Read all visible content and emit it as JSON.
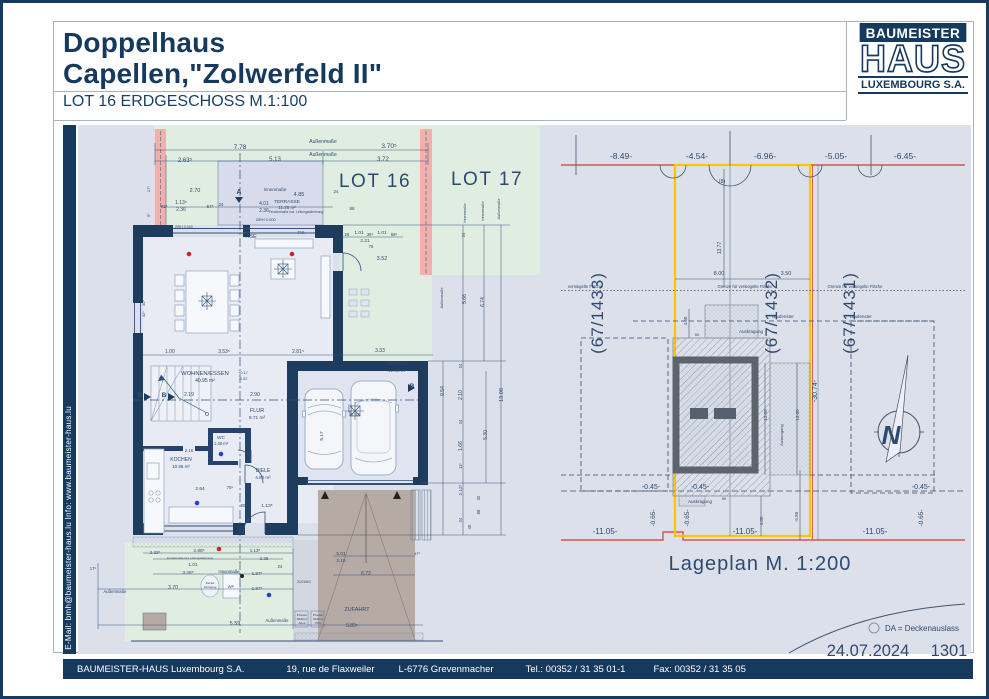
{
  "header": {
    "title_line1": "Doppelhaus",
    "title_line2": "Capellen,\"Zolwerfeld II\"",
    "subtitle": "LOT 16 ERDGESCHOSS  M.1:100"
  },
  "logo": {
    "top": "BAUMEISTER",
    "middle": "HAUS",
    "bottom": "LUXEMBOURG S.A."
  },
  "sidebar": {
    "contact": "E-Mail: bmh@baumeister-haus.lu    Info:    www.baumeister-haus.lu"
  },
  "footer": {
    "company": "BAUMEISTER-HAUS Luxembourg S.A.",
    "address": "19, rue de Flaxweiler",
    "city": "L-6776 Grevenmacher",
    "tel": "Tel.: 00352 / 31 35 01-1",
    "fax": "Fax: 00352 / 31 35 05"
  },
  "colors": {
    "navy": "#16395e",
    "drawing_bg": "#dbe0eb",
    "lot_green": "#dfeee0",
    "firewall_pink": "#f1b0ac",
    "terrace": "#d7dbeb",
    "driveway_taupe": "#b5aaa4",
    "boundary_red": "#d95448",
    "boundary_yellow": "#fdc500",
    "north_blue": "#1b1bdd"
  },
  "floor_plan": {
    "labels": [
      {
        "t": "Außenmaße",
        "x": 320,
        "y": 140,
        "s": 5
      },
      {
        "t": "7.78",
        "x": 237,
        "y": 146,
        "s": 6.5
      },
      {
        "t": "3.70⁵",
        "x": 386,
        "y": 145,
        "s": 6.5
      },
      {
        "t": "Außenmaße",
        "x": 320,
        "y": 153,
        "s": 5
      },
      {
        "t": "2.63⁵",
        "x": 182,
        "y": 159,
        "s": 6
      },
      {
        "t": "5.13",
        "x": 272,
        "y": 158,
        "s": 6
      },
      {
        "t": "3.72",
        "x": 380,
        "y": 158,
        "s": 6
      },
      {
        "t": "LOT 16",
        "x": 372,
        "y": 184,
        "s": 19,
        "c": "#2e4d73",
        "ls": 1.5,
        "n": "lot16-label"
      },
      {
        "t": "LOT 17",
        "x": 484,
        "y": 182,
        "s": 19,
        "c": "#2e4d73",
        "ls": 1.5,
        "n": "lot17-label"
      },
      {
        "t": "Innenmaße",
        "x": 272,
        "y": 188,
        "s": 4.5
      },
      {
        "t": "2.70",
        "x": 192,
        "y": 189,
        "s": 5.5
      },
      {
        "t": "4.85",
        "x": 296,
        "y": 193,
        "s": 5.5
      },
      {
        "t": "A",
        "x": 236,
        "y": 191,
        "s": 7,
        "b": 1,
        "n": "section-marker-a"
      },
      {
        "t": "TERRASSE",
        "x": 284,
        "y": 200,
        "s": 4.8,
        "n": "room-terrasse"
      },
      {
        "t": "11.25 m²",
        "x": 284,
        "y": 206,
        "s": 4.5
      },
      {
        "t": "92⁵",
        "x": 161,
        "y": 205,
        "s": 4.5
      },
      {
        "t": "1.13⁵",
        "x": 178,
        "y": 201,
        "s": 5
      },
      {
        "t": "2.36",
        "x": 178,
        "y": 208,
        "s": 5
      },
      {
        "t": "57⁵",
        "x": 207,
        "y": 205,
        "s": 4.5
      },
      {
        "t": "24",
        "x": 218,
        "y": 203,
        "s": 4.5
      },
      {
        "t": "4.01",
        "x": 261,
        "y": 202,
        "s": 5
      },
      {
        "t": "2.36",
        "x": 261,
        "y": 209,
        "s": 5
      },
      {
        "t": "Fenstermaße incl. Leitungsdämmung",
        "x": 293,
        "y": 210,
        "s": 3.3
      },
      {
        "t": "BRH 0.000",
        "x": 263,
        "y": 218,
        "s": 4
      },
      {
        "t": "88",
        "x": 349,
        "y": 207,
        "s": 4.5
      },
      {
        "t": "24",
        "x": 333,
        "y": 190,
        "s": 4.5
      },
      {
        "t": "17⁵",
        "x": 147,
        "y": 186,
        "s": 4,
        "r": -90
      },
      {
        "t": "9⁵",
        "x": 147,
        "y": 212,
        "s": 4,
        "r": -90
      },
      {
        "t": "30⁵",
        "x": 142,
        "y": 300,
        "s": 4,
        "r": -90
      },
      {
        "t": "42⁵",
        "x": 142,
        "y": 311,
        "s": 4,
        "r": -90
      },
      {
        "t": "BRH 0.000",
        "x": 181,
        "y": 225,
        "s": 3.6
      },
      {
        "t": "HSE",
        "x": 248,
        "y": 235,
        "s": 5.5
      },
      {
        "t": "FIX",
        "x": 298,
        "y": 231,
        "s": 4.5
      },
      {
        "t": "26",
        "x": 344,
        "y": 233,
        "s": 4.2
      },
      {
        "t": "1.01",
        "x": 356,
        "y": 231,
        "s": 4.8
      },
      {
        "t": "36⁵",
        "x": 367,
        "y": 233,
        "s": 4.2
      },
      {
        "t": "1.01",
        "x": 379,
        "y": 231,
        "s": 4.8
      },
      {
        "t": "69⁵",
        "x": 391,
        "y": 233,
        "s": 4.2
      },
      {
        "t": "2.21",
        "x": 362,
        "y": 239,
        "s": 4.8
      },
      {
        "t": "76",
        "x": 368,
        "y": 245,
        "s": 4.2
      },
      {
        "t": "3.52",
        "x": 379,
        "y": 257,
        "s": 5.5
      },
      {
        "t": "WOHNEN/ESSEN",
        "x": 202,
        "y": 372,
        "s": 5.8,
        "n": "room-wohnen-essen"
      },
      {
        "t": "40.95 m²",
        "x": 202,
        "y": 379,
        "s": 5
      },
      {
        "t": "1.00",
        "x": 167,
        "y": 350,
        "s": 5
      },
      {
        "t": "3.53⁵",
        "x": 221,
        "y": 350,
        "s": 5
      },
      {
        "t": "2.81⁵",
        "x": 295,
        "y": 350,
        "s": 5
      },
      {
        "t": "3.33",
        "x": 377,
        "y": 349,
        "s": 5
      },
      {
        "t": "GARAGE",
        "x": 394,
        "y": 362,
        "s": 5.5,
        "n": "room-garage"
      },
      {
        "t": "41.90 m²",
        "x": 394,
        "y": 369,
        "s": 4.8
      },
      {
        "t": "B",
        "x": 137,
        "y": 394,
        "s": 6.5,
        "b": 1,
        "n": "section-marker-b"
      },
      {
        "t": "B",
        "x": 161,
        "y": 394,
        "s": 6.5,
        "b": 1,
        "n": "section-marker-b"
      },
      {
        "t": "B",
        "x": 409,
        "y": 385,
        "s": 6.5,
        "b": 1,
        "n": "section-marker-b"
      },
      {
        "t": "2.19",
        "x": 186,
        "y": 393,
        "s": 5
      },
      {
        "t": "2.90",
        "x": 252,
        "y": 393,
        "s": 5
      },
      {
        "t": "+0.17",
        "x": 240,
        "y": 371,
        "s": 3.8
      },
      {
        "t": "-0.02",
        "x": 240,
        "y": 377,
        "s": 3.8
      },
      {
        "t": "FLUR",
        "x": 254,
        "y": 409,
        "s": 5.5,
        "n": "room-flur"
      },
      {
        "t": "9.71 m²",
        "x": 254,
        "y": 416,
        "s": 4.8
      },
      {
        "t": "WC",
        "x": 218,
        "y": 436,
        "s": 4.8,
        "n": "room-wc"
      },
      {
        "t": "1.48 m²",
        "x": 218,
        "y": 442,
        "s": 4.2
      },
      {
        "t": "DIELE",
        "x": 260,
        "y": 469,
        "s": 5,
        "n": "room-diele"
      },
      {
        "t": "4.80 m²",
        "x": 260,
        "y": 476,
        "s": 4.5
      },
      {
        "t": "KOCHEN",
        "x": 178,
        "y": 458,
        "s": 5,
        "n": "room-kochen"
      },
      {
        "t": "10.96 m²",
        "x": 178,
        "y": 465,
        "s": 4.5
      },
      {
        "t": "2.16",
        "x": 186,
        "y": 449,
        "s": 4.2
      },
      {
        "t": "2.64",
        "x": 197,
        "y": 487,
        "s": 4.8
      },
      {
        "t": "75⁵",
        "x": 227,
        "y": 486,
        "s": 4.2
      },
      {
        "t": "50",
        "x": 240,
        "y": 504,
        "s": 4.2
      },
      {
        "t": "1.13⁵",
        "x": 264,
        "y": 504,
        "s": 4.8
      },
      {
        "t": "5.17",
        "x": 320,
        "y": 433,
        "s": 4.8,
        "r": -90
      },
      {
        "t": "6.52",
        "x": 352,
        "y": 413,
        "s": 4.8
      },
      {
        "t": "9.54",
        "x": 441,
        "y": 388,
        "s": 5,
        "r": -90
      },
      {
        "t": "24",
        "x": 459,
        "y": 363,
        "s": 4.2,
        "r": -90
      },
      {
        "t": "2.10",
        "x": 459,
        "y": 392,
        "s": 5,
        "r": -90
      },
      {
        "t": "24",
        "x": 459,
        "y": 419,
        "s": 4.2,
        "r": -90
      },
      {
        "t": "1.66",
        "x": 459,
        "y": 443,
        "s": 5,
        "r": -90
      },
      {
        "t": "11⁵",
        "x": 459,
        "y": 463,
        "s": 4.2,
        "r": -90
      },
      {
        "t": "2.12⁵",
        "x": 459,
        "y": 487,
        "s": 4.6,
        "r": -90
      },
      {
        "t": "24",
        "x": 459,
        "y": 517,
        "s": 4.2,
        "r": -90
      },
      {
        "t": "30",
        "x": 477,
        "y": 495,
        "s": 4.2,
        "r": -90
      },
      {
        "t": "88",
        "x": 477,
        "y": 509,
        "s": 4.2,
        "r": -90
      },
      {
        "t": "46",
        "x": 468,
        "y": 524,
        "s": 4.2,
        "r": -90
      },
      {
        "t": "5.30",
        "x": 484,
        "y": 432,
        "s": 5,
        "r": -90
      },
      {
        "t": "13.08",
        "x": 500,
        "y": 392,
        "s": 5.5,
        "r": -90
      },
      {
        "t": "Außenmaße",
        "x": 440,
        "y": 295,
        "s": 3.8,
        "r": -90
      },
      {
        "t": "5.66",
        "x": 463,
        "y": 296,
        "s": 5,
        "r": -90
      },
      {
        "t": "6.74",
        "x": 481,
        "y": 299,
        "s": 5,
        "r": -90
      },
      {
        "t": "Innenmaße",
        "x": 463,
        "y": 210,
        "s": 3.8,
        "r": -90
      },
      {
        "t": "Innenmaße",
        "x": 481,
        "y": 208,
        "s": 3.8,
        "r": -90
      },
      {
        "t": "Außenmaße",
        "x": 497,
        "y": 206,
        "s": 3.8,
        "r": -90
      },
      {
        "t": "24",
        "x": 462,
        "y": 232,
        "s": 4.2,
        "r": -90
      },
      {
        "t": "2.32⁵",
        "x": 152,
        "y": 551,
        "s": 4.5
      },
      {
        "t": "2.88⁵",
        "x": 196,
        "y": 549,
        "s": 4.8
      },
      {
        "t": "Fenstermaße incl. Leitungsdämmung",
        "x": 187,
        "y": 556,
        "s": 2.8
      },
      {
        "t": "1.01",
        "x": 190,
        "y": 563,
        "s": 4.8
      },
      {
        "t": "1.13⁵",
        "x": 252,
        "y": 549,
        "s": 4.5
      },
      {
        "t": "2.36",
        "x": 261,
        "y": 557,
        "s": 4.5
      },
      {
        "t": "24",
        "x": 277,
        "y": 565,
        "s": 4.2
      },
      {
        "t": "17⁵",
        "x": 90,
        "y": 567,
        "s": 4.2
      },
      {
        "t": "Innenmaße",
        "x": 226,
        "y": 570,
        "s": 4.2
      },
      {
        "t": "3.28⁵",
        "x": 185,
        "y": 571,
        "s": 4.8
      },
      {
        "t": "Außenmaße",
        "x": 112,
        "y": 590,
        "s": 4.2
      },
      {
        "t": "3.70",
        "x": 170,
        "y": 586,
        "s": 5
      },
      {
        "t": "1.87⁵",
        "x": 254,
        "y": 572,
        "s": 4.6
      },
      {
        "t": "1.87⁵",
        "x": 254,
        "y": 587,
        "s": 4.6
      },
      {
        "t": "WP",
        "x": 228,
        "y": 585,
        "s": 4,
        "n": "wp-unit"
      },
      {
        "t": "Deckel",
        "x": 207,
        "y": 581,
        "s": 2.8
      },
      {
        "t": "Reinigung",
        "x": 207,
        "y": 585,
        "s": 2.8
      },
      {
        "t": "5.59",
        "x": 232,
        "y": 622,
        "s": 5.5
      },
      {
        "t": "Außenmaße",
        "x": 274,
        "y": 619,
        "s": 4.2
      },
      {
        "t": "ZUGANG",
        "x": 301,
        "y": 580,
        "s": 3.2,
        "n": "zugang-label"
      },
      {
        "t": "Pfosten",
        "x": 299,
        "y": 613,
        "s": 3
      },
      {
        "t": "Müllbox",
        "x": 299,
        "y": 617,
        "s": 3
      },
      {
        "t": "Aqua",
        "x": 299,
        "y": 621,
        "s": 3
      },
      {
        "t": "Pfosten",
        "x": 315,
        "y": 613,
        "s": 3
      },
      {
        "t": "Müllbox",
        "x": 315,
        "y": 617,
        "s": 3
      },
      {
        "t": "ÖKO",
        "x": 315,
        "y": 621,
        "s": 3
      },
      {
        "t": "ZUFAHRT",
        "x": 354,
        "y": 608,
        "s": 5.5,
        "n": "zufahrt-label"
      },
      {
        "t": "5.01",
        "x": 338,
        "y": 552,
        "s": 4.8
      },
      {
        "t": "2.15",
        "x": 338,
        "y": 559,
        "s": 4.8
      },
      {
        "t": "47⁵",
        "x": 414,
        "y": 552,
        "s": 4
      },
      {
        "t": "6.72",
        "x": 363,
        "y": 572,
        "s": 5
      },
      {
        "t": "5.89⁵",
        "x": 349,
        "y": 624,
        "s": 5
      }
    ]
  },
  "site_plan": {
    "labels": [
      {
        "t": "-8.49-",
        "x": 618,
        "y": 156,
        "s": 8.5
      },
      {
        "t": "-4.54-",
        "x": 694,
        "y": 156,
        "s": 8.5
      },
      {
        "t": "-6.96-",
        "x": 762,
        "y": 156,
        "s": 8.5
      },
      {
        "t": "-5.05-",
        "x": 833,
        "y": 156,
        "s": 8.5
      },
      {
        "t": "-6.45-",
        "x": 902,
        "y": 156,
        "s": 8.5
      },
      {
        "t": "(8)",
        "x": 719,
        "y": 180,
        "s": 5.5
      },
      {
        "t": "(67/1433)",
        "x": 600,
        "y": 310,
        "s": 17,
        "r": -90,
        "c": "#2e4d73",
        "ls": 1,
        "n": "parcel-67-1433"
      },
      {
        "t": "(67/1432)",
        "x": 774,
        "y": 310,
        "s": 17,
        "r": -90,
        "c": "#2e4d73",
        "ls": 1,
        "n": "parcel-67-1432"
      },
      {
        "t": "(67/1431)",
        "x": 852,
        "y": 310,
        "s": 17,
        "r": -90,
        "c": "#2e4d73",
        "ls": 1,
        "n": "parcel-67-1431"
      },
      {
        "t": "8.00",
        "x": 716,
        "y": 272,
        "s": 5.5
      },
      {
        "t": "3.50",
        "x": 783,
        "y": 272,
        "s": 5.5
      },
      {
        "t": "13.77",
        "x": 718,
        "y": 245,
        "s": 5,
        "r": -90
      },
      {
        "t": "versiegelte Fläche",
        "x": 582,
        "y": 285,
        "s": 4.2
      },
      {
        "t": "Grenze für versiegelte Fläche",
        "x": 742,
        "y": 285,
        "s": 4.2
      },
      {
        "t": "Grenze für versiegelte Fläche",
        "x": 852,
        "y": 285,
        "s": 4.2
      },
      {
        "t": "Baufenster",
        "x": 780,
        "y": 315,
        "s": 4.5
      },
      {
        "t": "Baufenster",
        "x": 858,
        "y": 315,
        "s": 4.5
      },
      {
        "t": "Auskragung",
        "x": 748,
        "y": 330,
        "s": 4.5
      },
      {
        "t": "4.00",
        "x": 684,
        "y": 318,
        "s": 4.5,
        "r": -90
      },
      {
        "t": "50",
        "x": 694,
        "y": 333,
        "s": 4
      },
      {
        "t": "-30.74-",
        "x": 814,
        "y": 388,
        "s": 7,
        "r": -90
      },
      {
        "t": "13.00",
        "x": 764,
        "y": 412,
        "s": 4.5,
        "r": -90
      },
      {
        "t": "13.00",
        "x": 796,
        "y": 412,
        "s": 4.5,
        "r": -90
      },
      {
        "t": "Auskragung",
        "x": 780,
        "y": 432,
        "s": 4,
        "r": -90
      },
      {
        "t": "Auskragung",
        "x": 697,
        "y": 500,
        "s": 4.5
      },
      {
        "t": "50",
        "x": 721,
        "y": 497,
        "s": 4
      },
      {
        "t": "4.00",
        "x": 760,
        "y": 518,
        "s": 4.5,
        "r": -90
      },
      {
        "t": "-5.50",
        "x": 795,
        "y": 514,
        "s": 4.5,
        "r": -90
      },
      {
        "t": "-0.45-",
        "x": 648,
        "y": 486,
        "s": 7
      },
      {
        "t": "-0.45-",
        "x": 697,
        "y": 486,
        "s": 7
      },
      {
        "t": "-0.45-",
        "x": 918,
        "y": 486,
        "s": 7
      },
      {
        "t": "-0.65-",
        "x": 652,
        "y": 515,
        "s": 6.5,
        "r": -90
      },
      {
        "t": "-0.65-",
        "x": 686,
        "y": 515,
        "s": 6.5,
        "r": -90
      },
      {
        "t": "-0.65-",
        "x": 920,
        "y": 515,
        "s": 6.5,
        "r": -90
      },
      {
        "t": "-11.05-",
        "x": 602,
        "y": 531,
        "s": 8
      },
      {
        "t": "-11.05-",
        "x": 742,
        "y": 531,
        "s": 8
      },
      {
        "t": "-11.05-",
        "x": 872,
        "y": 531,
        "s": 8
      },
      {
        "t": "N",
        "x": 888,
        "y": 441,
        "s": 26,
        "b": 1,
        "i": 1,
        "c": "#1b1bdd",
        "n": "north-letter"
      },
      {
        "t": "Lageplan M. 1:200",
        "x": 757,
        "y": 567,
        "s": 20,
        "c": "#2e4d73",
        "ls": 1,
        "n": "site-plan-title"
      },
      {
        "t": "DA = Deckenauslass",
        "x": 882,
        "y": 628,
        "s": 8,
        "a": "start",
        "n": "legend-da"
      },
      {
        "t": "24.07.2024",
        "x": 865,
        "y": 653,
        "s": 16.5,
        "c": "#1d3f66",
        "n": "sheet-date"
      },
      {
        "t": "1301",
        "x": 946,
        "y": 653,
        "s": 16.5,
        "c": "#1d3f66",
        "n": "sheet-number"
      }
    ]
  }
}
